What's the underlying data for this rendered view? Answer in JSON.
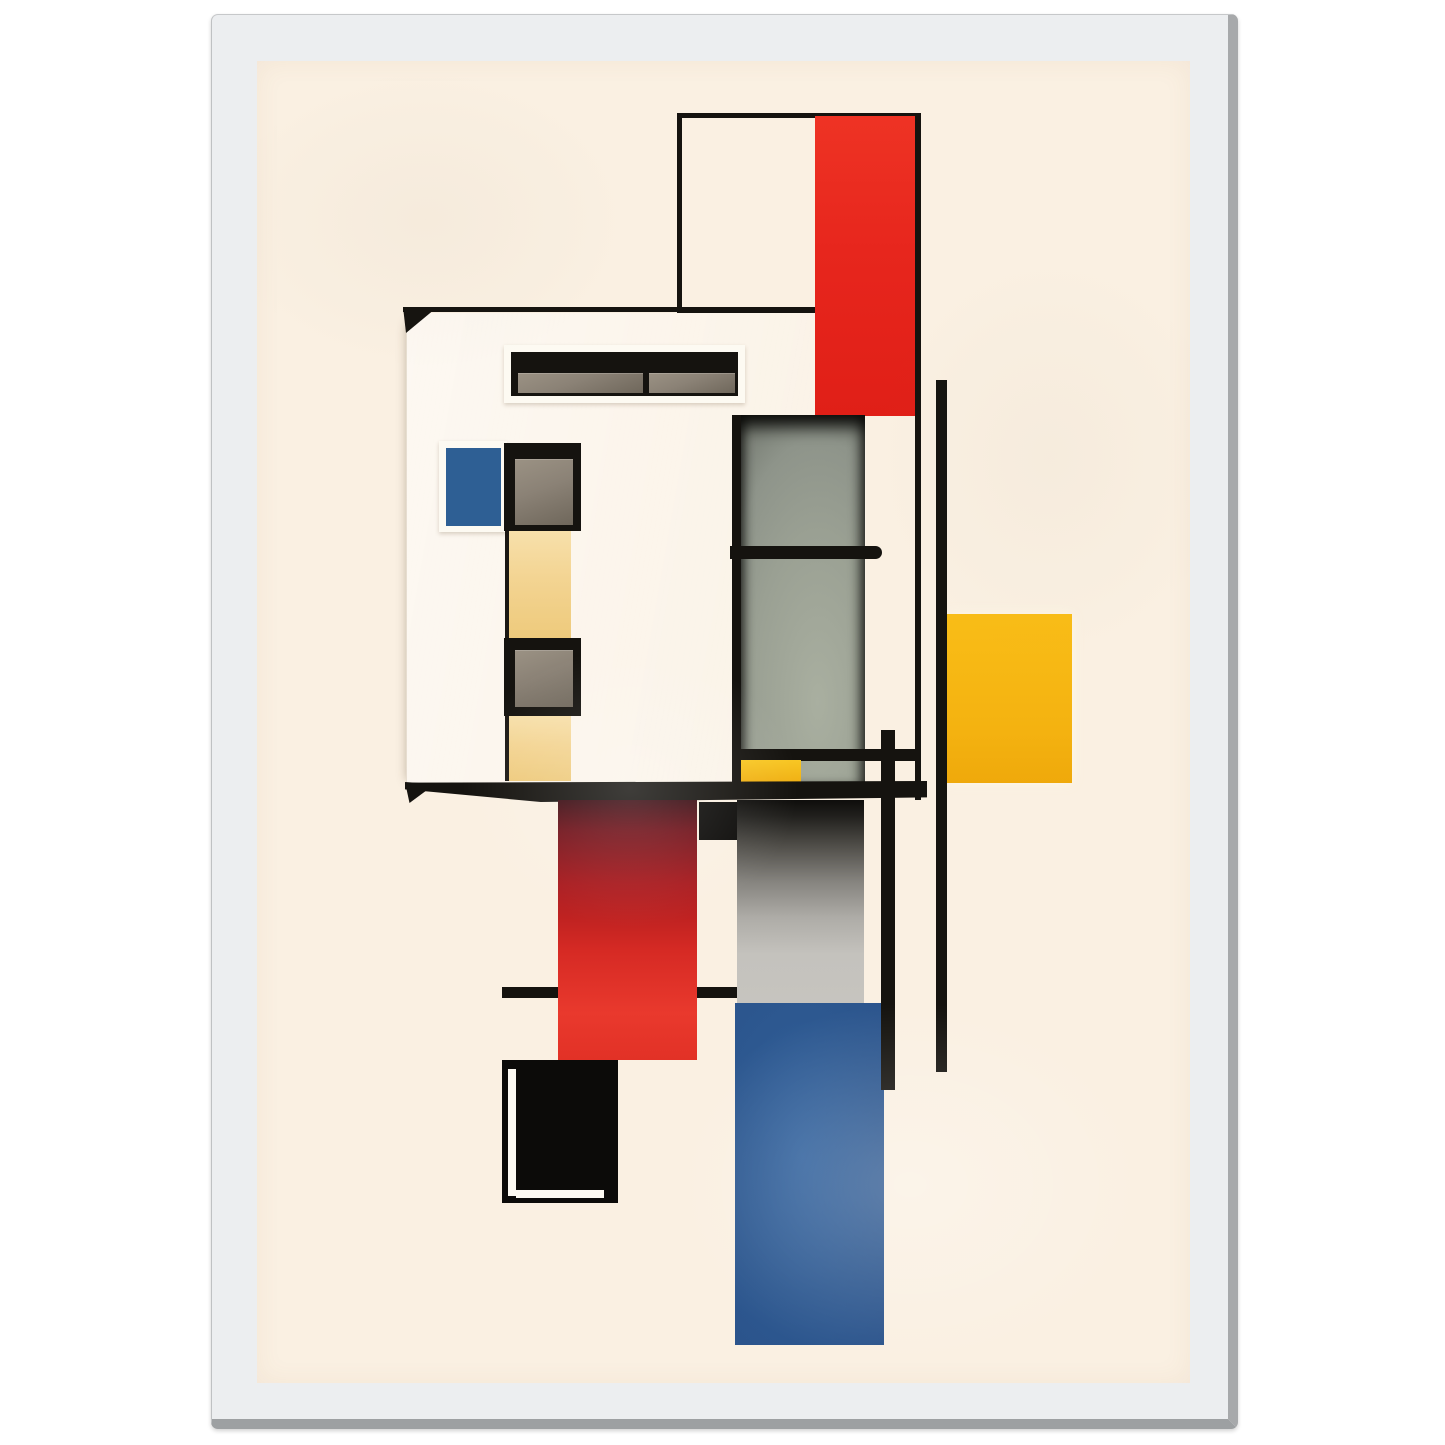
{
  "product": {
    "kind": "framed-art-print",
    "frame_color": "#eceef0",
    "frame_edge_color": "#a7a9ab",
    "paper_color": "#faf0e2"
  },
  "palette": {
    "ink": "#15130f",
    "inkDeep": "#0c0b09",
    "paper": "#faf0e2",
    "paperWhite": "#fdfaf2",
    "facadeWhite": "#fdf6e9",
    "red": "#e7261d",
    "blueSquare": "#2e5f94",
    "blueColumn": "#2d5890",
    "yellow": "#f4b210",
    "paleYellow": "#f3d492",
    "gray": "#9aa093",
    "grayLight": "#c6c4bf",
    "pane": "#8b8276",
    "frameFace": "#eceef0",
    "frameEdge": "#a7a9ab"
  },
  "artwork": {
    "shapes": [
      {
        "name": "facade-panel",
        "rect": [
          149,
          252,
          460,
          473
        ],
        "cls": "facade"
      },
      {
        "name": "lower-rule-line",
        "rect": [
          245,
          926,
          235,
          11
        ],
        "fill": "ink"
      },
      {
        "name": "roof-line",
        "rect": [
          146,
          246,
          412,
          5
        ],
        "fill": "ink"
      },
      {
        "name": "roof-arrow",
        "rect": [
          146,
          246,
          30,
          26
        ],
        "fill": "ink",
        "clip": "polygon(0 0, 100% 14%, 10% 100%)"
      },
      {
        "name": "outline-box",
        "rect": [
          420,
          52,
          244,
          200
        ],
        "cls": "outline-box"
      },
      {
        "name": "red-block-top",
        "rect": [
          558,
          55,
          102,
          300
        ],
        "cls": "red-top"
      },
      {
        "name": "window-strip-frame",
        "rect": [
          247,
          284,
          241,
          58
        ],
        "cls": "white-frame shadow-sm"
      },
      {
        "name": "window-strip-glass",
        "rect": [
          254,
          291,
          227,
          44
        ],
        "fill": "ink"
      },
      {
        "name": "window-strip-pane-left",
        "rect": [
          261,
          312,
          125,
          20
        ],
        "cls": "pane"
      },
      {
        "name": "window-strip-pane-right",
        "rect": [
          392,
          312,
          86,
          20
        ],
        "cls": "pane"
      },
      {
        "name": "blue-window-frame",
        "rect": [
          182,
          380,
          68,
          91
        ],
        "cls": "white-frame shadow-sm"
      },
      {
        "name": "blue-window",
        "rect": [
          189,
          387,
          55,
          78
        ],
        "fill": "blueSquare"
      },
      {
        "name": "window-upper-frame",
        "rect": [
          247,
          382,
          77,
          88
        ],
        "fill": "ink"
      },
      {
        "name": "window-upper-pane",
        "rect": [
          258,
          398,
          58,
          66
        ],
        "cls": "pane"
      },
      {
        "name": "yellow-column-upper",
        "rect": [
          248,
          470,
          66,
          107
        ],
        "cls": "pale-yellow"
      },
      {
        "name": "window-lower-frame",
        "rect": [
          247,
          577,
          77,
          78
        ],
        "fill": "ink"
      },
      {
        "name": "window-lower-pane",
        "rect": [
          258,
          589,
          58,
          57
        ],
        "cls": "pane"
      },
      {
        "name": "yellow-column-lower",
        "rect": [
          248,
          655,
          66,
          65
        ],
        "cls": "pale-yellow"
      },
      {
        "name": "gray-niche",
        "rect": [
          475,
          354,
          133,
          368
        ],
        "cls": "niche"
      },
      {
        "name": "niche-shelf-bar",
        "rect": [
          473,
          485,
          152,
          13
        ],
        "fill": "ink",
        "cls": "rounded-right"
      },
      {
        "name": "mid-rail-line",
        "rect": [
          478,
          688,
          182,
          12
        ],
        "fill": "ink"
      },
      {
        "name": "yellow-bar-small",
        "rect": [
          477,
          699,
          67,
          28
        ],
        "cls": "small-yellow"
      },
      {
        "name": "yellow-square-large",
        "rect": [
          689,
          553,
          126,
          169
        ],
        "cls": "big-yellow"
      },
      {
        "name": "vertical-line-inner",
        "rect": [
          658,
          52,
          6,
          687
        ],
        "fill": "ink"
      },
      {
        "name": "vertical-line-outer",
        "rect": [
          679,
          319,
          11,
          692
        ],
        "fill": "ink"
      },
      {
        "name": "floor-slab",
        "rect": [
          148,
          720,
          522,
          21
        ],
        "fill": "ink",
        "clip": "polygon(0 8%, 100% 0, 100% 78%, 26% 100%, 0 40%)"
      },
      {
        "name": "slab-arrow",
        "rect": [
          148,
          721,
          30,
          21
        ],
        "fill": "ink",
        "clip": "polygon(0 0, 100% 10%, 15% 100%)"
      },
      {
        "name": "black-square-small",
        "rect": [
          442,
          741,
          39,
          38
        ],
        "fill": "inkDeep"
      },
      {
        "name": "red-column-lower",
        "rect": [
          301,
          739,
          139,
          260
        ],
        "cls": "red-column"
      },
      {
        "name": "gray-column-lower",
        "rect": [
          480,
          739,
          127,
          203
        ],
        "cls": "gray-column"
      },
      {
        "name": "blue-column-lower",
        "rect": [
          478,
          942,
          149,
          342
        ],
        "cls": "blue-column"
      },
      {
        "name": "post-line",
        "rect": [
          624,
          669,
          14,
          360
        ],
        "fill": "ink"
      },
      {
        "name": "black-frame-box",
        "rect": [
          245,
          999,
          116,
          143
        ],
        "fill": "inkDeep"
      },
      {
        "name": "frame-box-highlight-left",
        "rect": [
          251,
          1008,
          8,
          127
        ],
        "fill": "paperWhite"
      },
      {
        "name": "frame-box-highlight-bottom",
        "rect": [
          259,
          1129,
          88,
          8
        ],
        "fill": "paperWhite"
      }
    ]
  }
}
